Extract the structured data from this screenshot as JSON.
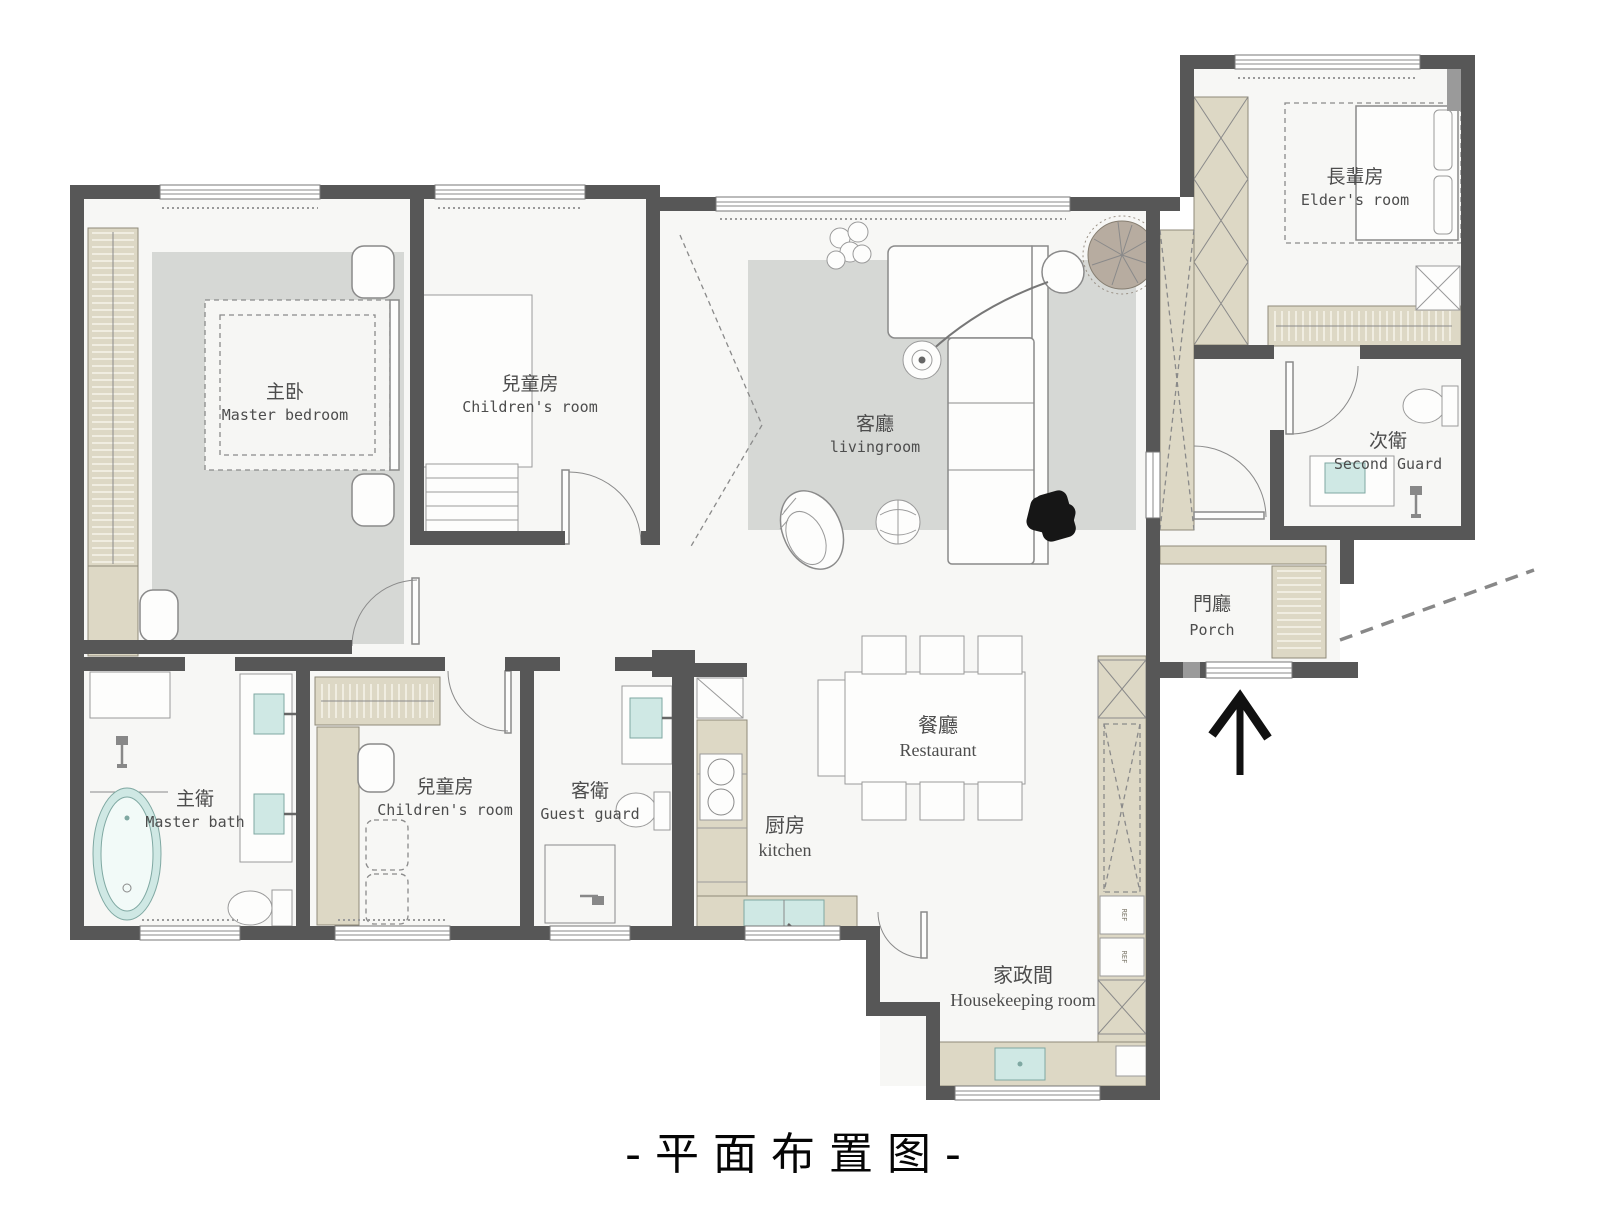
{
  "title": "-平面布置图-",
  "rooms": {
    "master_bedroom": {
      "zh": "主卧",
      "en": "Master bedroom"
    },
    "children_room_top": {
      "zh": "兒童房",
      "en": "Children's room"
    },
    "living_room": {
      "zh": "客廳",
      "en": "livingroom"
    },
    "elders_room": {
      "zh": "長輩房",
      "en": "Elder's room"
    },
    "second_guard": {
      "zh": "次衛",
      "en": "Second Guard"
    },
    "porch": {
      "zh": "門廳",
      "en": "Porch"
    },
    "restaurant": {
      "zh": "餐廳",
      "en": "Restaurant"
    },
    "kitchen": {
      "zh": "厨房",
      "en": "kitchen"
    },
    "housekeeping_room": {
      "zh": "家政間",
      "en": "Housekeeping room"
    },
    "master_bath": {
      "zh": "主衛",
      "en": "Master bath"
    },
    "children_room_bottom": {
      "zh": "兒童房",
      "en": "Children's room"
    },
    "guest_guard": {
      "zh": "客衛",
      "en": "Guest guard"
    }
  },
  "cabinets": {
    "ref_label": "REF"
  },
  "icons": {
    "entry_arrow": "arrow-up"
  },
  "colors": {
    "wall_dark": "#575757",
    "wall_mid": "#9a9a9a",
    "cabinet": "#ddd8c5",
    "fixture": "#cfe8e4",
    "rug": "#d6d8d5",
    "floor": "#f7f7f5"
  }
}
